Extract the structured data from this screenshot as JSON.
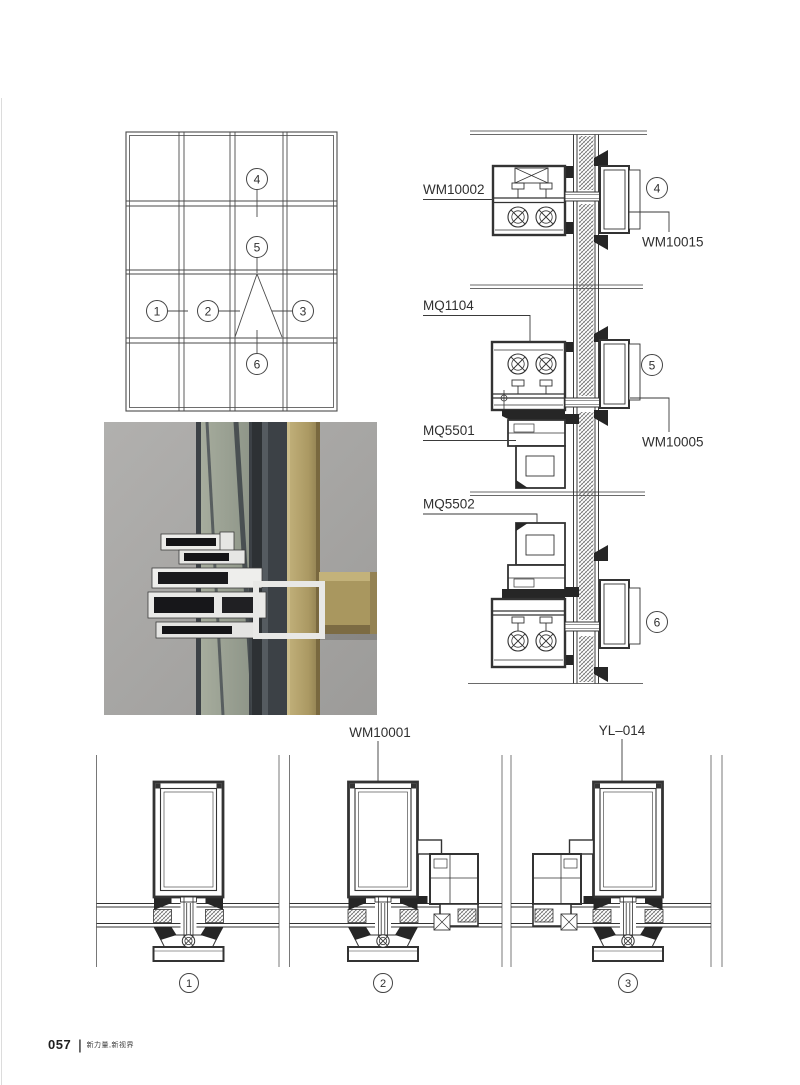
{
  "document": {
    "kind": "aluminium curtain wall section details catalog page"
  },
  "callouts": {
    "n1": "1",
    "n2": "2",
    "n3": "3",
    "n4": "4",
    "n5": "5",
    "n6": "6"
  },
  "vertical_sections": {
    "labels": {
      "wm10002": "WM10002",
      "wm10015": "WM10015",
      "mq1104": "MQ1104",
      "mq5501": "MQ5501",
      "wm10005": "WM10005",
      "mq5502": "MQ5502"
    }
  },
  "horizontal_sections": {
    "labels": {
      "wm10001": "WM10001",
      "yl014": "YL–014"
    }
  },
  "photo": {
    "colors": {
      "background_gray": "#a8a7a5",
      "mullion_gold": "#b3a169",
      "mullion_gold_dark": "#7c6b43",
      "frame_dark": "#3c4146",
      "glass_green": "#9aa193",
      "profile_white": "#e9e9e7",
      "cavity_dark": "#17171a"
    }
  },
  "drawing": {
    "line_color": "#3a3a3a",
    "break_line_color": "#6a6a6a"
  },
  "footer": {
    "page_number": "057",
    "divider": "|",
    "slogan": "新力量,新视界"
  }
}
